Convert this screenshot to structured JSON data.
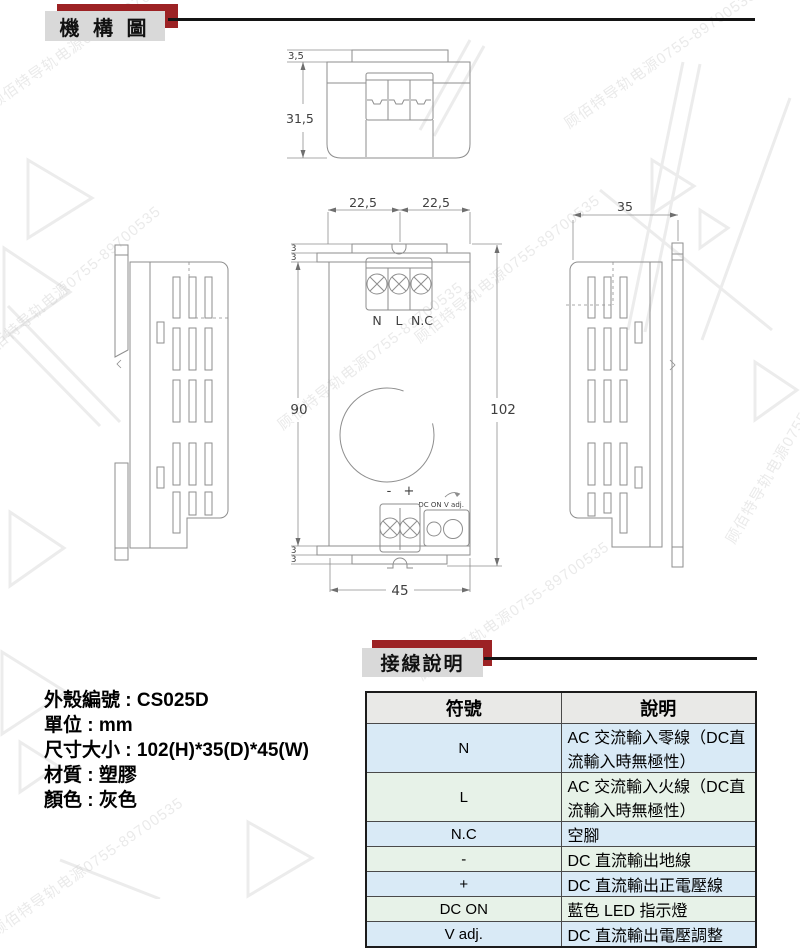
{
  "header": {
    "title": "機 構 圖"
  },
  "wiring_header": {
    "title": "接線說明"
  },
  "drawings": {
    "top_view": {
      "dim_tab_height": "3,5",
      "dim_view_height": "31,5"
    },
    "front_view": {
      "dim_width_left": "22,5",
      "dim_width_right": "22,5",
      "dim_step_top_a": "3",
      "dim_step_top_b": "3",
      "dim_body_height": "90",
      "dim_total_height": "102",
      "dim_step_bottom_a": "3",
      "dim_step_bottom_b": "3",
      "dim_width_bottom": "45",
      "terminal_n": "N",
      "terminal_l": "L",
      "terminal_nc": "N.C",
      "terminal_minus": "-",
      "terminal_plus": "+",
      "label_dc_on": "DC ON",
      "label_v_adj": "V adj."
    },
    "right_view": {
      "dim_depth": "35"
    }
  },
  "specs": {
    "lines": [
      "外殼編號 : CS025D",
      "單位 : mm",
      "尺寸大小 : 102(H)*35(D)*45(W)",
      "材質 : 塑膠",
      "顏色 : 灰色"
    ]
  },
  "wiring_table": {
    "headers": [
      "符號",
      "說明"
    ],
    "rows": [
      {
        "symbol": "N",
        "description": "AC 交流輸入零線（DC直流輸入時無極性）"
      },
      {
        "symbol": "L",
        "description": "AC 交流輸入火線（DC直流輸入時無極性）"
      },
      {
        "symbol": "N.C",
        "description": "空腳"
      },
      {
        "symbol": "-",
        "description": "DC 直流輸出地線"
      },
      {
        "symbol": "+",
        "description": "DC 直流輸出正電壓線"
      },
      {
        "symbol": "DC ON",
        "description": "藍色 LED 指示燈"
      },
      {
        "symbol": "V adj.",
        "description": "DC 直流輸出電壓調整"
      }
    ]
  },
  "watermark": {
    "text": "顾佰特导轨电源0755-89700535"
  },
  "colors": {
    "ribbon_red": "#9c2224",
    "ribbon_gray": "#d9d9d9",
    "row_blue": "#d9eaf6",
    "row_green": "#e7f2e8",
    "header_gray": "#e9e9e7",
    "drawing_line_gray": "#8e8e8e"
  }
}
